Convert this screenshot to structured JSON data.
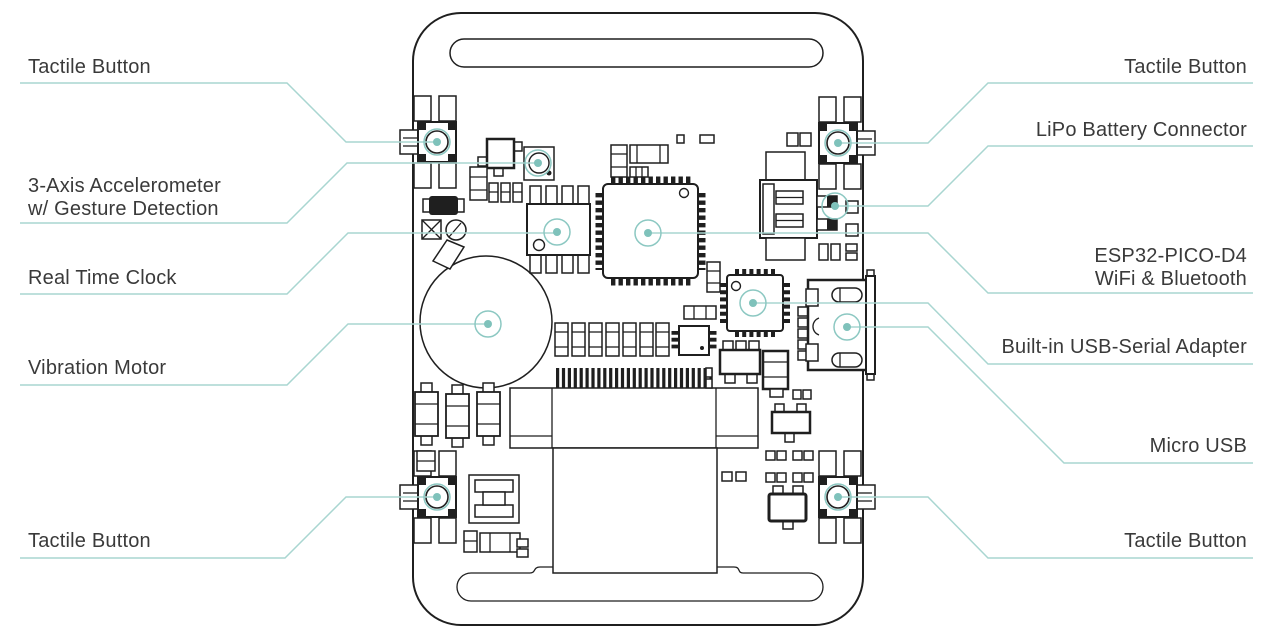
{
  "colors": {
    "line": "#a9d6d1",
    "marker": "#8cc8c2",
    "dot": "#7fc2bb",
    "ink": "#1f1f1f",
    "text": "#3a3a3a"
  },
  "callouts": [
    {
      "id": "tactile-button-top-left",
      "lines": [
        "Tactile Button"
      ],
      "points": "20,83 287,83 346,142 437,142",
      "marker": [
        437,
        142
      ]
    },
    {
      "id": "accelerometer",
      "lines": [
        "3-Axis Accelerometer",
        "w/ Gesture Detection"
      ],
      "points": "20,223 287,223 347,163 538,163",
      "marker": [
        538,
        163
      ]
    },
    {
      "id": "real-time-clock",
      "lines": [
        "Real Time Clock"
      ],
      "points": "20,294 287,294 348,233 557,233",
      "marker": [
        557,
        232
      ]
    },
    {
      "id": "vibration-motor",
      "lines": [
        "Vibration Motor"
      ],
      "points": "20,385 287,385 348,324 488,324",
      "marker": [
        488,
        324
      ]
    },
    {
      "id": "tactile-button-bottom-left",
      "lines": [
        "Tactile Button"
      ],
      "points": "20,558 285,558 346,497 437,497",
      "marker": [
        437,
        497
      ]
    },
    {
      "id": "tactile-button-top-right",
      "lines": [
        "Tactile Button"
      ],
      "points": "1253,83 988,83 928,143 838,143",
      "marker": [
        838,
        143
      ]
    },
    {
      "id": "lipo-battery-connector",
      "lines": [
        "LiPo Battery Connector"
      ],
      "points": "1253,146 988,146 928,206 835,206",
      "marker": [
        835,
        206
      ]
    },
    {
      "id": "esp32-pico-d4",
      "lines": [
        "ESP32-PICO-D4",
        "WiFi & Bluetooth"
      ],
      "points": "1253,293 988,293 928,233 648,233",
      "marker": [
        648,
        233
      ]
    },
    {
      "id": "usb-serial-adapter",
      "lines": [
        "Built-in USB-Serial Adapter"
      ],
      "points": "1253,364 988,364 928,303 753,303",
      "marker": [
        753,
        303
      ]
    },
    {
      "id": "micro-usb",
      "lines": [
        "Micro USB"
      ],
      "points": "1253,463 1064,463 928,327 847,327",
      "marker": [
        847,
        327
      ]
    },
    {
      "id": "tactile-button-bottom-right",
      "lines": [
        "Tactile Button"
      ],
      "points": "1253,558 988,558 928,497 838,497",
      "marker": [
        838,
        497
      ]
    }
  ]
}
